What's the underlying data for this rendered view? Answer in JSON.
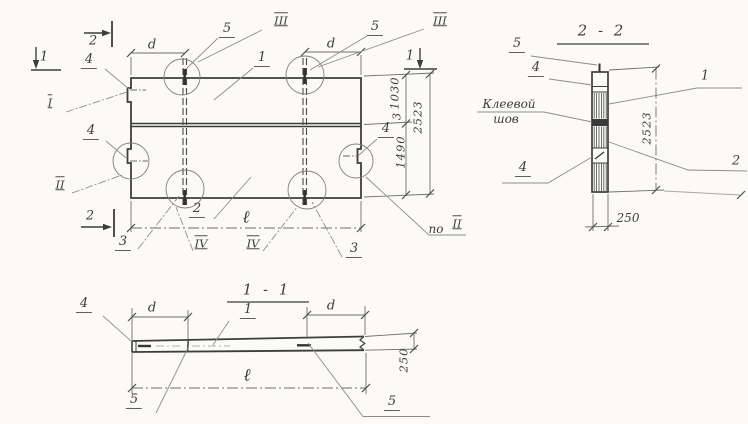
{
  "colors": {
    "paper": "#fbfaf6",
    "ink": "#3d3d3d",
    "line_light": "#8d8d8d"
  },
  "plan": {
    "marker_2_top": "2",
    "marker_2_bottom": "2",
    "marker_1_left": "1",
    "marker_1_right": "1",
    "dim_d_left": "d",
    "dim_d_right": "d",
    "dim_length": "ℓ",
    "dim_upper": "1030",
    "dim_seam": "3",
    "dim_lower": "1490",
    "dim_total": "2523",
    "callout_1": "1",
    "callout_2": "2",
    "callout_3_left": "3",
    "callout_3_right": "3",
    "callout_4_top_left": "4",
    "callout_4_left": "4",
    "callout_4_right": "4",
    "callout_5_left": "5",
    "callout_5_right": "5",
    "view_I": "I",
    "view_II": "II",
    "view_III_left": "III",
    "view_III_right": "III",
    "view_IV_left": "IV",
    "view_IV_right": "IV",
    "view_po": "по",
    "view_po_ref": "II"
  },
  "section_2_2": {
    "title": "2 - 2",
    "callout_5": "5",
    "callout_4_top": "4",
    "callout_4_bottom": "4",
    "callout_1": "1",
    "callout_2": "2",
    "glue_label_1": "Клеевой",
    "glue_label_2": "шов",
    "dim_total": "2523",
    "dim_thickness": "250"
  },
  "section_1_1": {
    "title": "1 - 1",
    "callout_4": "4",
    "callout_1": "1",
    "callout_5_left": "5",
    "callout_5_right": "5",
    "dim_d_left": "d",
    "dim_d_right": "d",
    "dim_length": "ℓ",
    "dim_thickness": "250"
  }
}
